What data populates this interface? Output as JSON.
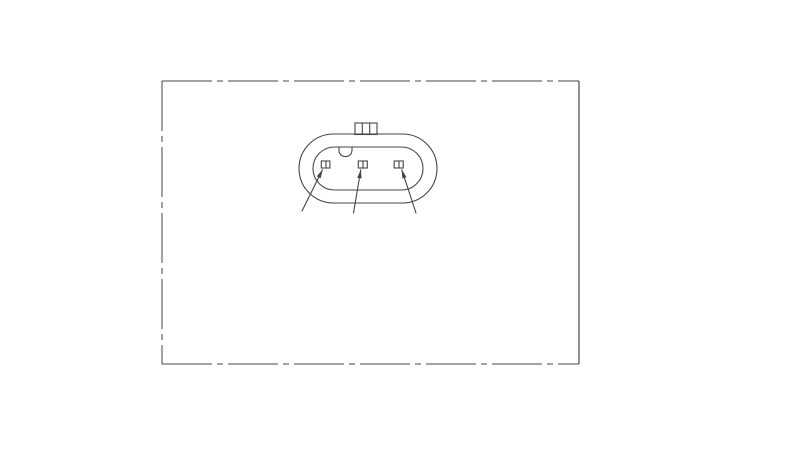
{
  "canvas": {
    "width": 800,
    "height": 451,
    "background": "#ffffff",
    "line_color": "#454545"
  },
  "frame": {
    "left": 162,
    "top": 81,
    "right": 579,
    "bottom": 364,
    "dash_pattern": [
      50,
      5,
      6,
      5
    ],
    "edge_styles": {
      "top": "phantom",
      "bottom": "phantom",
      "left": "phantom",
      "right": "solid"
    }
  },
  "connector": {
    "description": "3-pin oval connector face view",
    "outer_shell": {
      "x": 299,
      "y": 134,
      "width": 138,
      "height": 69
    },
    "inner_shell": {
      "x": 313,
      "y": 147,
      "width": 110,
      "height": 43
    },
    "latch_tab": {
      "x": 355,
      "y": 123,
      "width": 22,
      "height": 11.5,
      "ribs_x": [
        362.3,
        369.7
      ]
    },
    "key_notch": {
      "path": "M339,147.5 L339,150 C339,158.8 352,158.8 352,150 L352,147.5"
    },
    "pins": [
      {
        "id": "pin-1",
        "x": 321.3,
        "y": 161,
        "width": 8.6,
        "height": 7,
        "divider_x": 326
      },
      {
        "id": "pin-2",
        "x": 358.3,
        "y": 161,
        "width": 9,
        "height": 7,
        "divider_x": 363
      },
      {
        "id": "pin-3",
        "x": 394.2,
        "y": 161,
        "width": 9,
        "height": 7,
        "divider_x": 399
      }
    ],
    "leaders": [
      {
        "id": "leader-pin-1",
        "from": [
          302,
          211
        ],
        "to": [
          322.5,
          169.8
        ]
      },
      {
        "id": "leader-pin-2",
        "from": [
          353.5,
          213
        ],
        "to": [
          360.8,
          169.8
        ]
      },
      {
        "id": "leader-pin-3",
        "from": [
          416,
          213
        ],
        "to": [
          401.8,
          169.8
        ]
      }
    ]
  }
}
